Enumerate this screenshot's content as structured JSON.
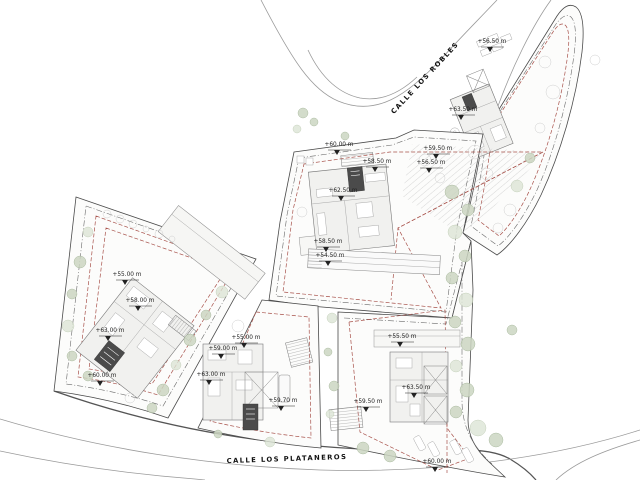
{
  "plan": {
    "kind": "architectural-site-plan",
    "streets": {
      "top": {
        "name": "CALLE LOS ROBLES"
      },
      "bottom": {
        "name": "CALLE LOS PLATANEROS"
      }
    },
    "elevation_labels": [
      {
        "text": "+56.50 m",
        "x": 492,
        "y": 43
      },
      {
        "text": "+63.50 m",
        "x": 463,
        "y": 111
      },
      {
        "text": "+59.50 m",
        "x": 438,
        "y": 150
      },
      {
        "text": "+56.50 m",
        "x": 431,
        "y": 164
      },
      {
        "text": "+60.00 m",
        "x": 339,
        "y": 146
      },
      {
        "text": "+58.50 m",
        "x": 377,
        "y": 163
      },
      {
        "text": "+62.50 m",
        "x": 343,
        "y": 192
      },
      {
        "text": "+58.50 m",
        "x": 328,
        "y": 243
      },
      {
        "text": "+54.50 m",
        "x": 330,
        "y": 257
      },
      {
        "text": "+55.00 m",
        "x": 127,
        "y": 276
      },
      {
        "text": "+58.00 m",
        "x": 140,
        "y": 302
      },
      {
        "text": "+63.00 m",
        "x": 110,
        "y": 332
      },
      {
        "text": "+60.00 m",
        "x": 102,
        "y": 377
      },
      {
        "text": "+55.00 m",
        "x": 246,
        "y": 339
      },
      {
        "text": "+59.00 m",
        "x": 223,
        "y": 350
      },
      {
        "text": "+63.00 m",
        "x": 211,
        "y": 376
      },
      {
        "text": "+59.70 m",
        "x": 283,
        "y": 402
      },
      {
        "text": "+55.50 m",
        "x": 402,
        "y": 338
      },
      {
        "text": "+63.50 m",
        "x": 416,
        "y": 389
      },
      {
        "text": "+59.50 m",
        "x": 368,
        "y": 403
      },
      {
        "text": "+60.00 m",
        "x": 437,
        "y": 463
      }
    ],
    "colors": {
      "background": "#ffffff",
      "plot_line": "#4a4a4a",
      "setback_line": "#a8524b",
      "vegetation": "#ccd6c2",
      "road_line": "#9a9a9a",
      "dark_element": "#4b4b4b"
    }
  }
}
